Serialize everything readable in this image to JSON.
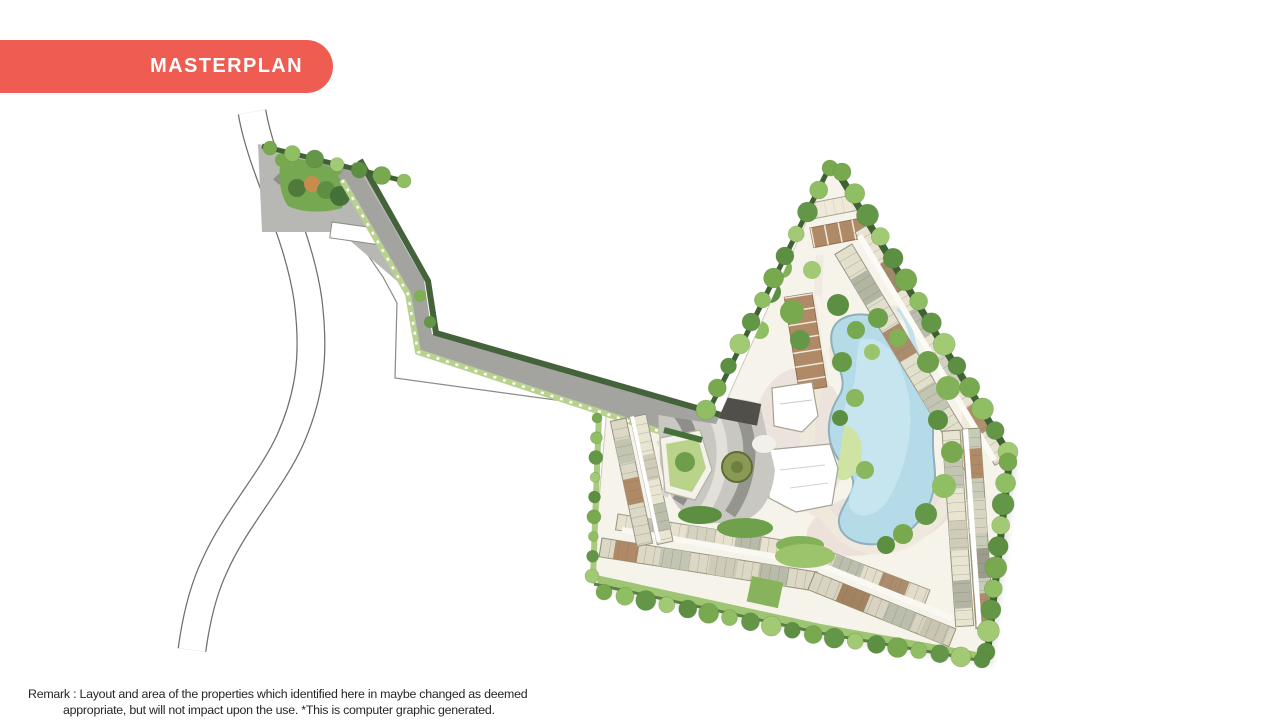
{
  "theme": {
    "accent": "#ee5c52",
    "ink": "#262626",
    "background": "#ffffff"
  },
  "badge": {
    "label": "MASTERPLAN"
  },
  "remark": {
    "line1": "Remark : Layout  and area of the properties which identified here in maybe changed as deemed",
    "line2": "appropriate, but will not impact upon the use. *This is computer graphic generated."
  },
  "plan_colors": {
    "water": "#b4dbe7",
    "water_light": "#cfe9f1",
    "lawn": "#76a851",
    "hedge_dark": "#3f6134",
    "road_gray": "#a3a3a0",
    "paving_gray": "#b7b7b4",
    "site_base": "#f6f3ea",
    "building_cream": "#e9e4d2",
    "building_gray": "#c3c5b3",
    "building_tan": "#b08a66",
    "path_cream": "#efe9dc",
    "path_pink": "#e8dcd7"
  }
}
